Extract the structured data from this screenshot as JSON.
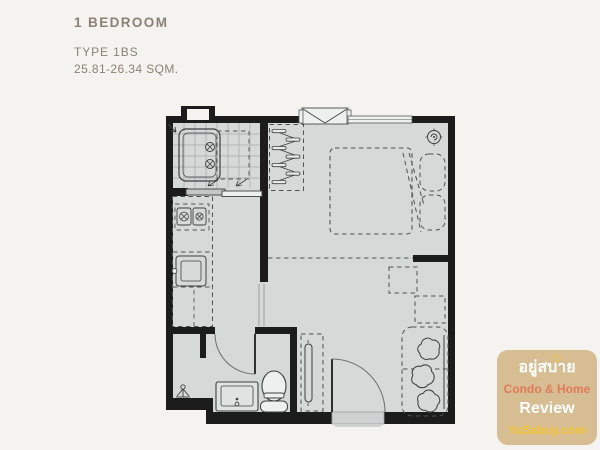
{
  "page": {
    "background_color": "#f5f3ef"
  },
  "header": {
    "title": "1 BEDROOM",
    "plan_type": "TYPE 1BS",
    "area_range": "25.81-26.34 SQM.",
    "text_color": "#8b8175"
  },
  "floorplan": {
    "colors": {
      "wall": "#1c1c1c",
      "floor": "#d5dad9",
      "furniture_line": "#4f5453",
      "tile_line": "#a4aaa9"
    },
    "rooms": [
      "balcony",
      "kitchen",
      "bathroom",
      "wardrobe",
      "bedroom",
      "living-area"
    ],
    "fixtures": [
      {
        "name": "ac-condenser-unit",
        "room": "balcony"
      },
      {
        "name": "sliding-door",
        "room": "balcony"
      },
      {
        "name": "clothes-rail-hangers",
        "room": "wardrobe"
      },
      {
        "name": "air-conditioner",
        "room": "bedroom"
      },
      {
        "name": "window",
        "room": "bedroom"
      },
      {
        "name": "ceiling-fan",
        "room": "bedroom"
      },
      {
        "name": "double-bed",
        "room": "bedroom"
      },
      {
        "name": "pillows",
        "room": "bedroom"
      },
      {
        "name": "two-burner-stove",
        "room": "kitchen"
      },
      {
        "name": "kitchen-sink",
        "room": "kitchen"
      },
      {
        "name": "counter",
        "room": "kitchen"
      },
      {
        "name": "shower",
        "room": "bathroom"
      },
      {
        "name": "wash-basin",
        "room": "bathroom"
      },
      {
        "name": "toilet",
        "room": "bathroom"
      },
      {
        "name": "swing-door",
        "room": "bathroom"
      },
      {
        "name": "tv-console",
        "room": "living-area"
      },
      {
        "name": "side-tables",
        "room": "living-area"
      },
      {
        "name": "sofa",
        "room": "living-area"
      },
      {
        "name": "entrance-door",
        "room": "living-area"
      }
    ]
  },
  "watermark": {
    "badge_color": "#d7bd92",
    "line1": "อยู่สบาย",
    "smiley": "☺",
    "line2": "Condo & Home",
    "line3": "Review",
    "line4": "YuSabuy.com",
    "line1_color": "#ffffff",
    "line2_color": "#e07a58",
    "line3_color": "#ffffff",
    "line4_color": "#f2c230"
  }
}
